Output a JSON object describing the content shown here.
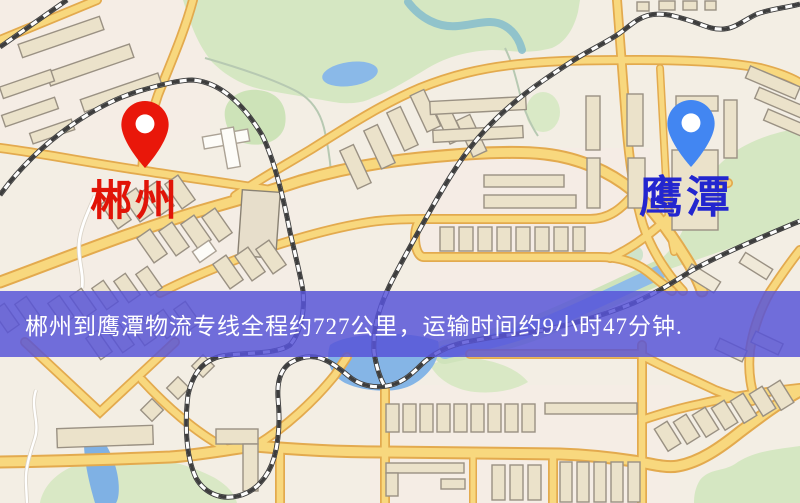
{
  "map": {
    "banner": {
      "text": "郴州到鹰潭物流专线全程约727公里，运输时间约9小时47分钟.",
      "background": "rgba(87,84,216,0.84)",
      "text_color": "#ffffff"
    },
    "markers": [
      {
        "name": "origin",
        "label": "郴州",
        "pin_color": "#e9170a",
        "label_color": "#e11408"
      },
      {
        "name": "destination",
        "label": "鹰潭",
        "pin_color": "#4286f2",
        "label_color": "#2326cf"
      }
    ],
    "route": {
      "distance": "约727公里",
      "duration": "约9小时47分钟"
    },
    "theme": {
      "land": "#f3eee4",
      "park": "#d5e7c2",
      "water": "#8ab9e8",
      "road_fill": "#f8d87e",
      "road_casing": "#e3aa4e",
      "building": "#ebe2ca",
      "railway": "#3d3d3d"
    }
  }
}
